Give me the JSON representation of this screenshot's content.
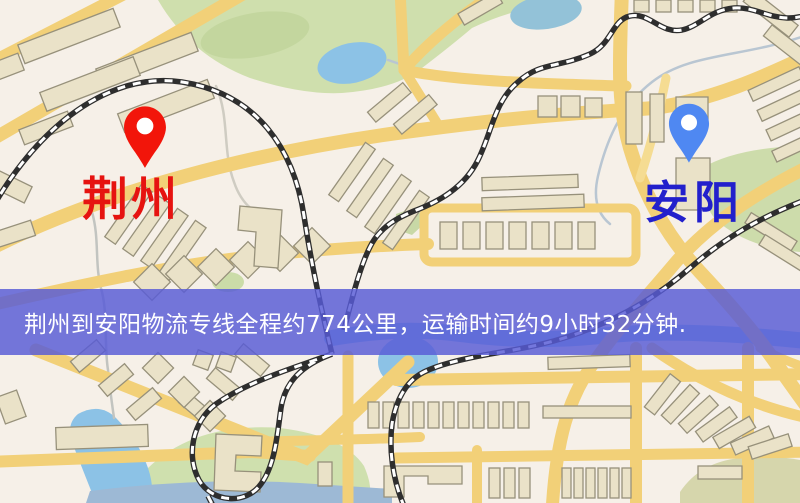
{
  "map": {
    "origin": {
      "name": "荆州",
      "pin_color": "#f2150a",
      "label_color": "#e61310"
    },
    "destination": {
      "name": "安阳",
      "pin_color": "#4f88f2",
      "label_color": "#2220cc"
    },
    "info_banner": {
      "text": "荆州到安阳物流专线全程约774公里，运输时间约9小时32分钟.",
      "background_color": "#585cd6",
      "text_color": "#ffffff"
    },
    "route": {
      "distance": "约774公里",
      "duration": "约9小时32分钟"
    },
    "palette": {
      "background": "#f6f0e8",
      "road": "#f2d078",
      "park": "#cfdfad",
      "water": "#8cc2e6",
      "building_fill": "#eae2c8",
      "railway": "#2e2e2e"
    }
  }
}
